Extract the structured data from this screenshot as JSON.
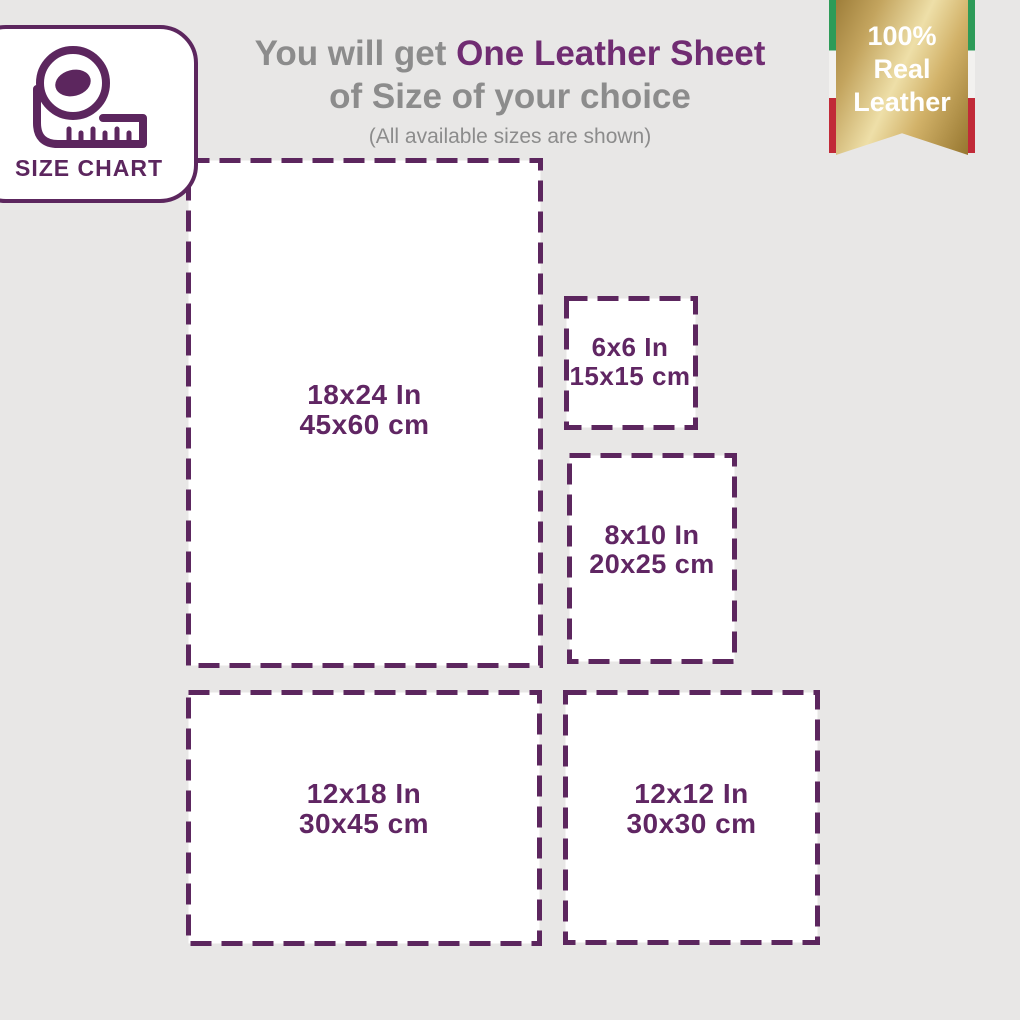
{
  "page": {
    "background": "#e8e7e6",
    "accent_purple": "#5c265e",
    "heading_purple": "#702c72",
    "text_gray": "#8c8c8c"
  },
  "size_chart_card": {
    "label": "SIZE CHART",
    "icon": "measuring-tape-icon"
  },
  "heading": {
    "prefix": "You will get ",
    "highlight": "One Leather Sheet",
    "line2": "of Size of your choice",
    "subtitle": "(All available sizes are shown)"
  },
  "badge": {
    "line1": "100%",
    "line2": "Real",
    "line3": "Leather",
    "gold_light": "#eedfa8",
    "gold_dark": "#9e7e3a",
    "flag_green": "#2d9b58",
    "flag_white": "#f2f1ef",
    "flag_red": "#c12a38"
  },
  "sizes": [
    {
      "id": "18x24",
      "inches": "18x24 In",
      "cm": "45x60 cm"
    },
    {
      "id": "6x6",
      "inches": "6x6 In",
      "cm": "15x15 cm"
    },
    {
      "id": "8x10",
      "inches": "8x10 In",
      "cm": "20x25 cm"
    },
    {
      "id": "12x18",
      "inches": "12x18 In",
      "cm": "30x45 cm"
    },
    {
      "id": "12x12",
      "inches": "12x12 In",
      "cm": "30x30 cm"
    }
  ]
}
